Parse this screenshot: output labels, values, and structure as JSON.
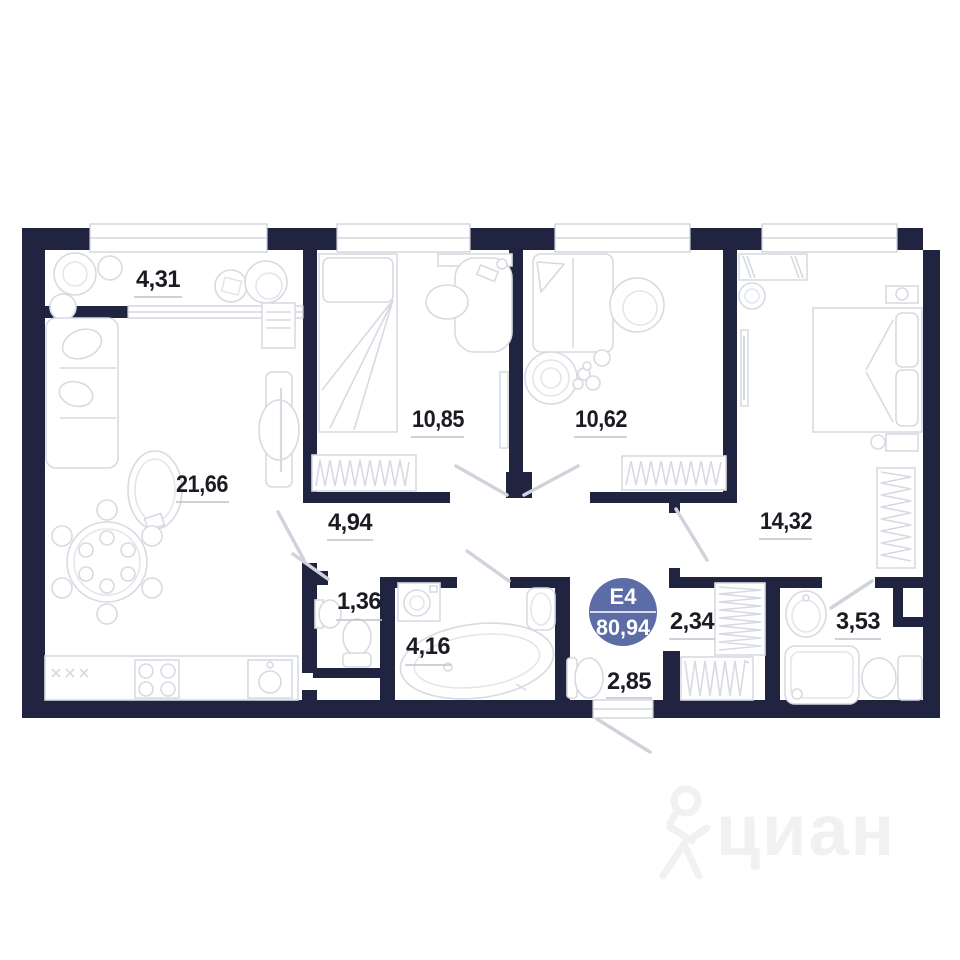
{
  "plan": {
    "badge": {
      "unit": "E4",
      "total_area": "80,94"
    },
    "rooms": [
      {
        "name": "balcony",
        "area": "4,31"
      },
      {
        "name": "living-kitchen",
        "area": "21,66"
      },
      {
        "name": "bedroom-1",
        "area": "10,85"
      },
      {
        "name": "bedroom-2",
        "area": "10,62"
      },
      {
        "name": "bedroom-3",
        "area": "14,32"
      },
      {
        "name": "hallway",
        "area": "4,94"
      },
      {
        "name": "wc",
        "area": "1,36"
      },
      {
        "name": "bathroom",
        "area": "4,16"
      },
      {
        "name": "entry-hall",
        "area": "2,85"
      },
      {
        "name": "wardrobe",
        "area": "2,34"
      },
      {
        "name": "shower-room",
        "area": "3,53"
      }
    ],
    "watermark": {
      "text": "циан"
    },
    "colors": {
      "wall": "#202440",
      "badge": "#5c6ca7",
      "furniture_line": "#d7dae1",
      "label_text": "#1b1c22",
      "watermark": "#f1f1f3"
    }
  }
}
